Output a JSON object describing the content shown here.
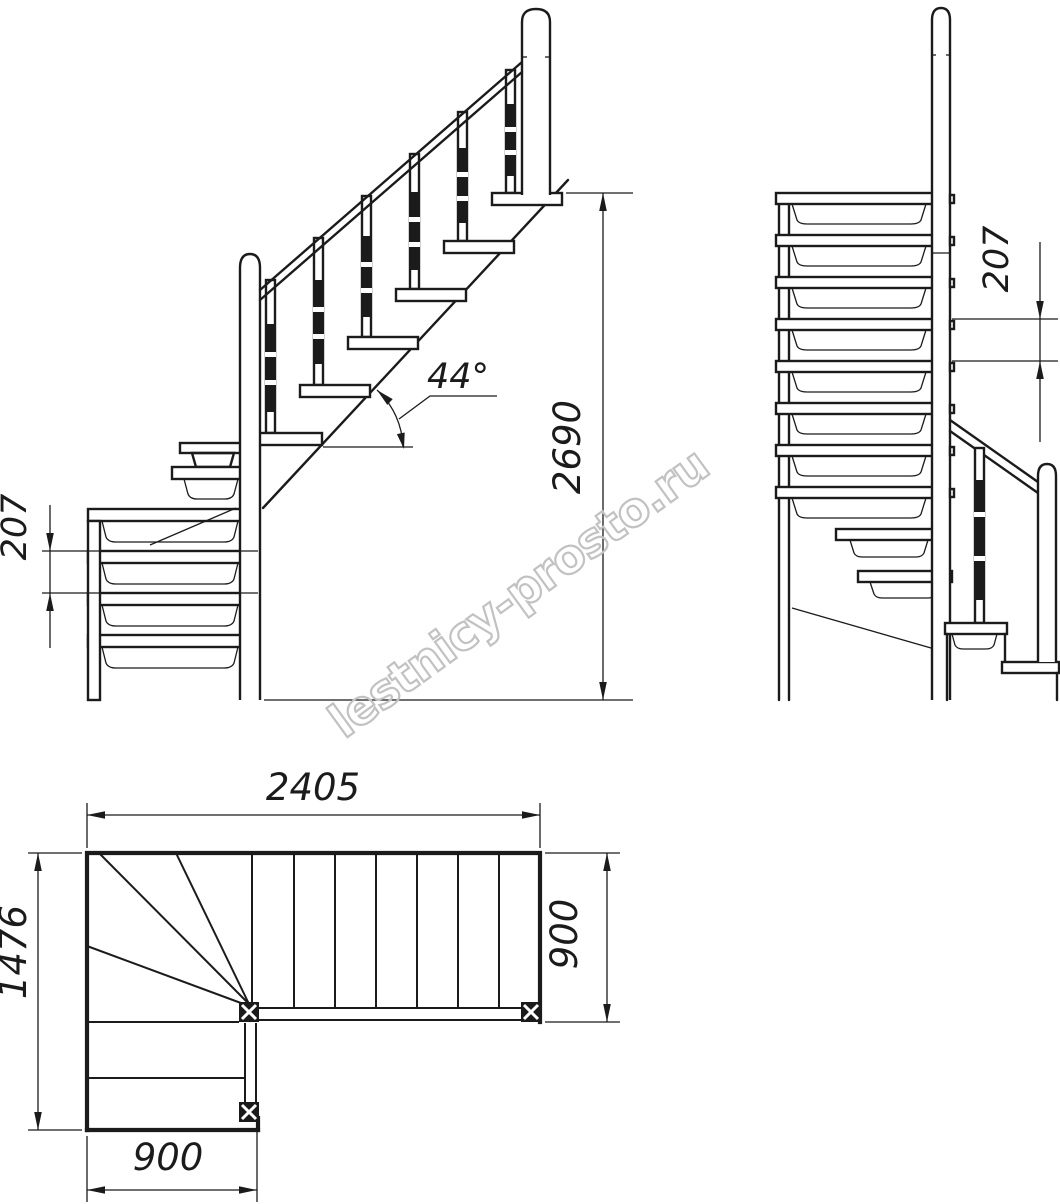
{
  "watermark": {
    "text": "lestnicy-prosto.ru"
  },
  "dims": {
    "total_rise": "2690",
    "angle": "44°",
    "riser_side": "207",
    "riser_front": "207",
    "plan_length": "2405",
    "plan_depth": "1476",
    "flight_width_right": "900",
    "flight_width_bottom": "900"
  }
}
